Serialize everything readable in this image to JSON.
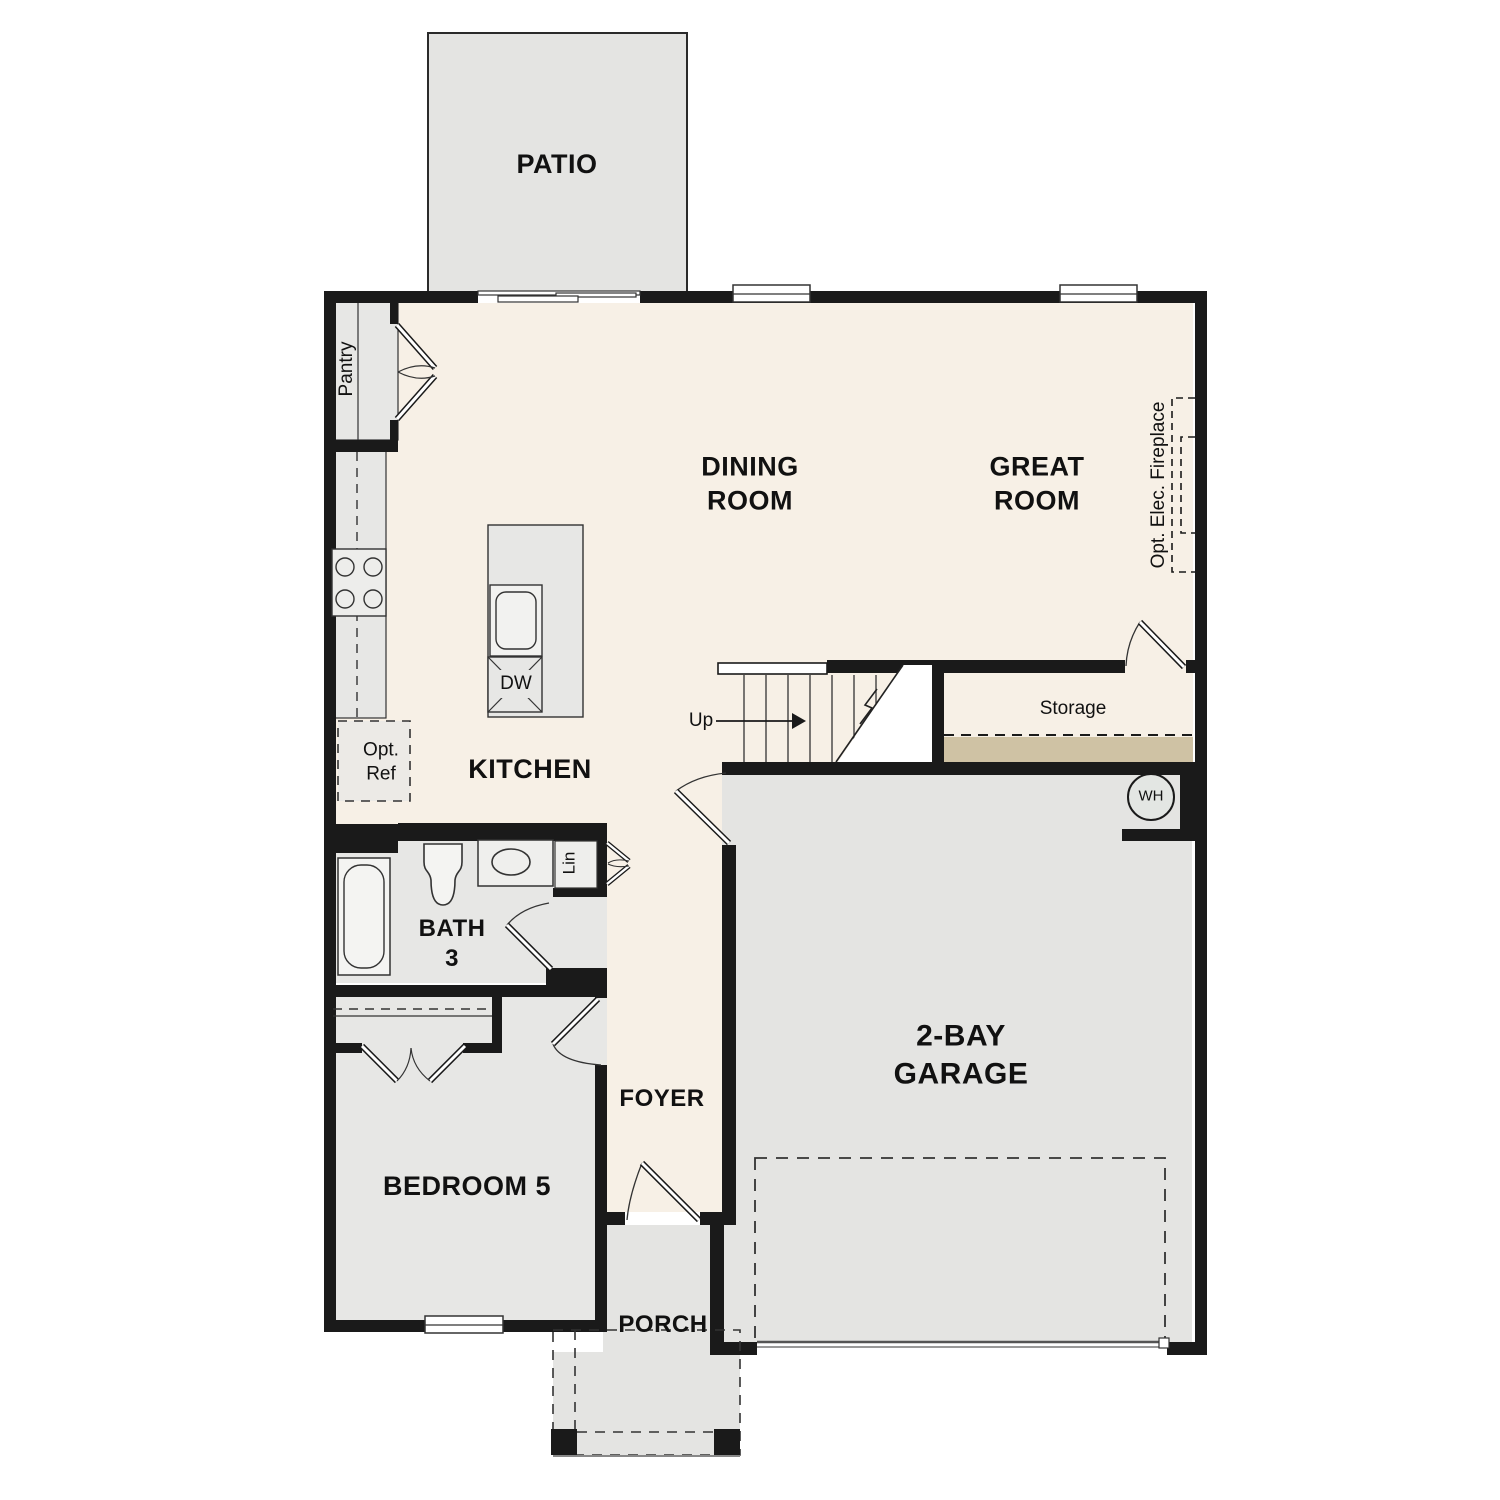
{
  "plan_title": "First Floor Plan",
  "colors": {
    "wall": "#1a1a1a",
    "floor_living_cream": "#f7f0e6",
    "floor_gray": "#e7e7e5",
    "patio_gray": "#e4e4e2",
    "storage_step_tan": "#cfc2a4",
    "garage_door_gray": "#555555"
  },
  "rooms": {
    "patio": {
      "label": "PATIO"
    },
    "dining": {
      "line1": "DINING",
      "line2": "ROOM"
    },
    "great": {
      "line1": "GREAT",
      "line2": "ROOM"
    },
    "kitchen": {
      "label": "KITCHEN"
    },
    "bath3": {
      "line1": "BATH",
      "line2": "3"
    },
    "bedroom5": {
      "label": "BEDROOM 5"
    },
    "foyer": {
      "label": "FOYER"
    },
    "porch": {
      "label": "PORCH"
    },
    "garage": {
      "line1": "2-BAY",
      "line2": "GARAGE"
    },
    "storage": {
      "label": "Storage"
    }
  },
  "features": {
    "pantry": "Pantry",
    "opt_ref_line1": "Opt.",
    "opt_ref_line2": "Ref",
    "dishwasher": "DW",
    "linen": "Lin",
    "stairs_up": "Up",
    "water_heater": "WH",
    "opt_fireplace": "Opt. Elec. Fireplace"
  }
}
